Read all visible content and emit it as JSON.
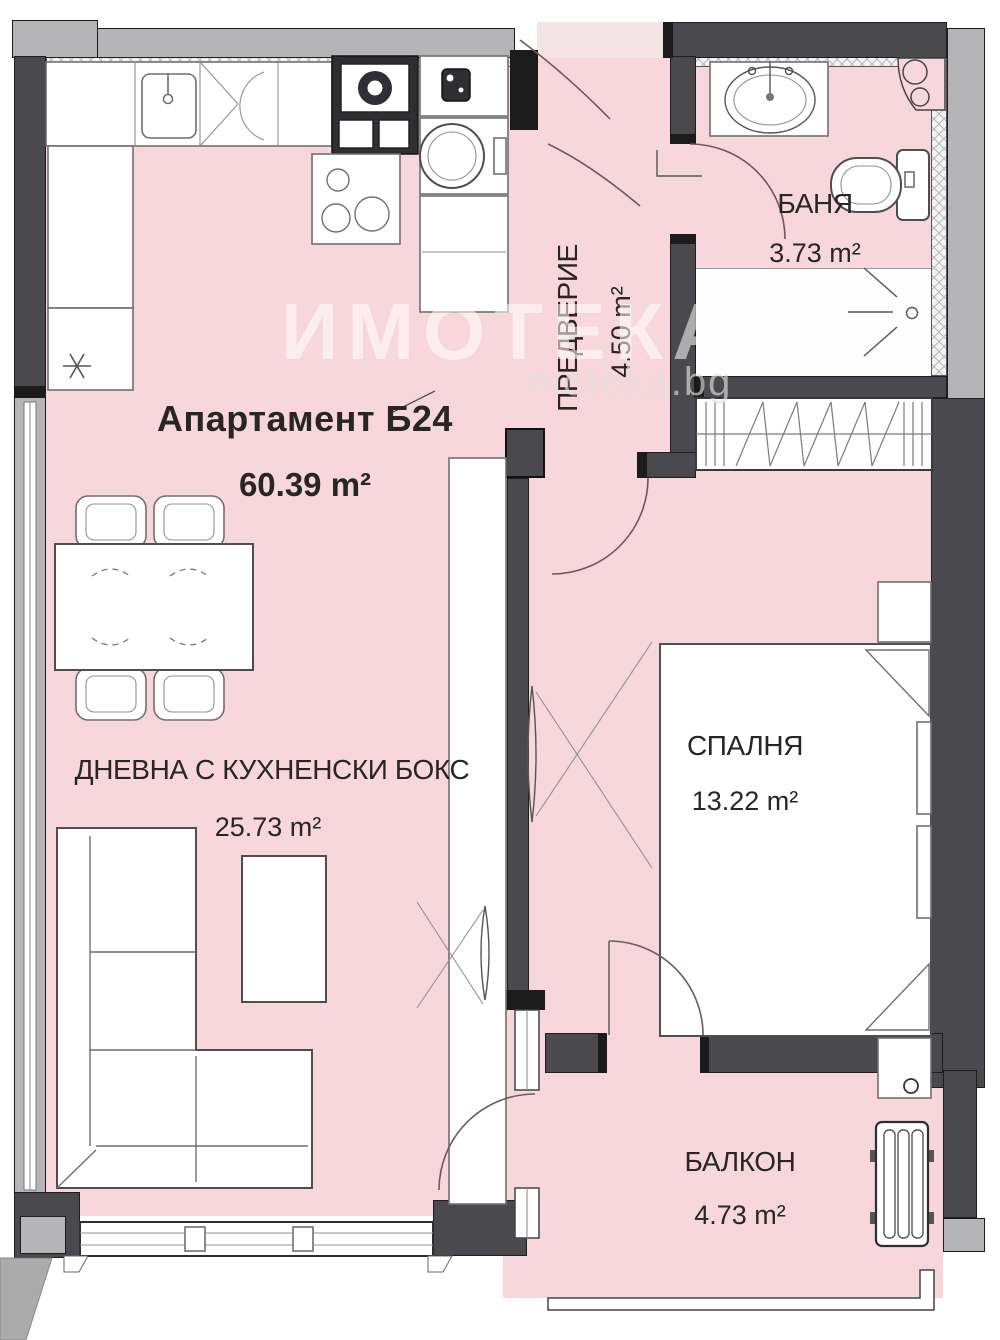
{
  "title": {
    "name": "Апартамент Б24",
    "area": "60.39 m²"
  },
  "rooms": {
    "living": {
      "name": "ДНЕВНА С КУХНЕНСКИ БОКС",
      "area": "25.73 m²"
    },
    "hallway": {
      "name": "ПРЕДВЕРИЕ",
      "area": "4.50 m²"
    },
    "bathroom": {
      "name": "БАНЯ",
      "area": "3.73 m²"
    },
    "bedroom": {
      "name": "СПАЛНЯ",
      "area": "13.22 m²"
    },
    "balcony": {
      "name": "БАЛКОН",
      "area": "4.73 m²"
    }
  },
  "watermark": {
    "brand": "ИМОТЕКА",
    "site": "moteka.bg"
  },
  "colors": {
    "room_fill": "#f8d7dc",
    "wall_dark": "#4a4a4e",
    "wall_light": "#b5b5b7",
    "wall_black": "#1b1b1b",
    "furniture_line": "#6f6f6f",
    "door_arc": "#6e585d"
  }
}
